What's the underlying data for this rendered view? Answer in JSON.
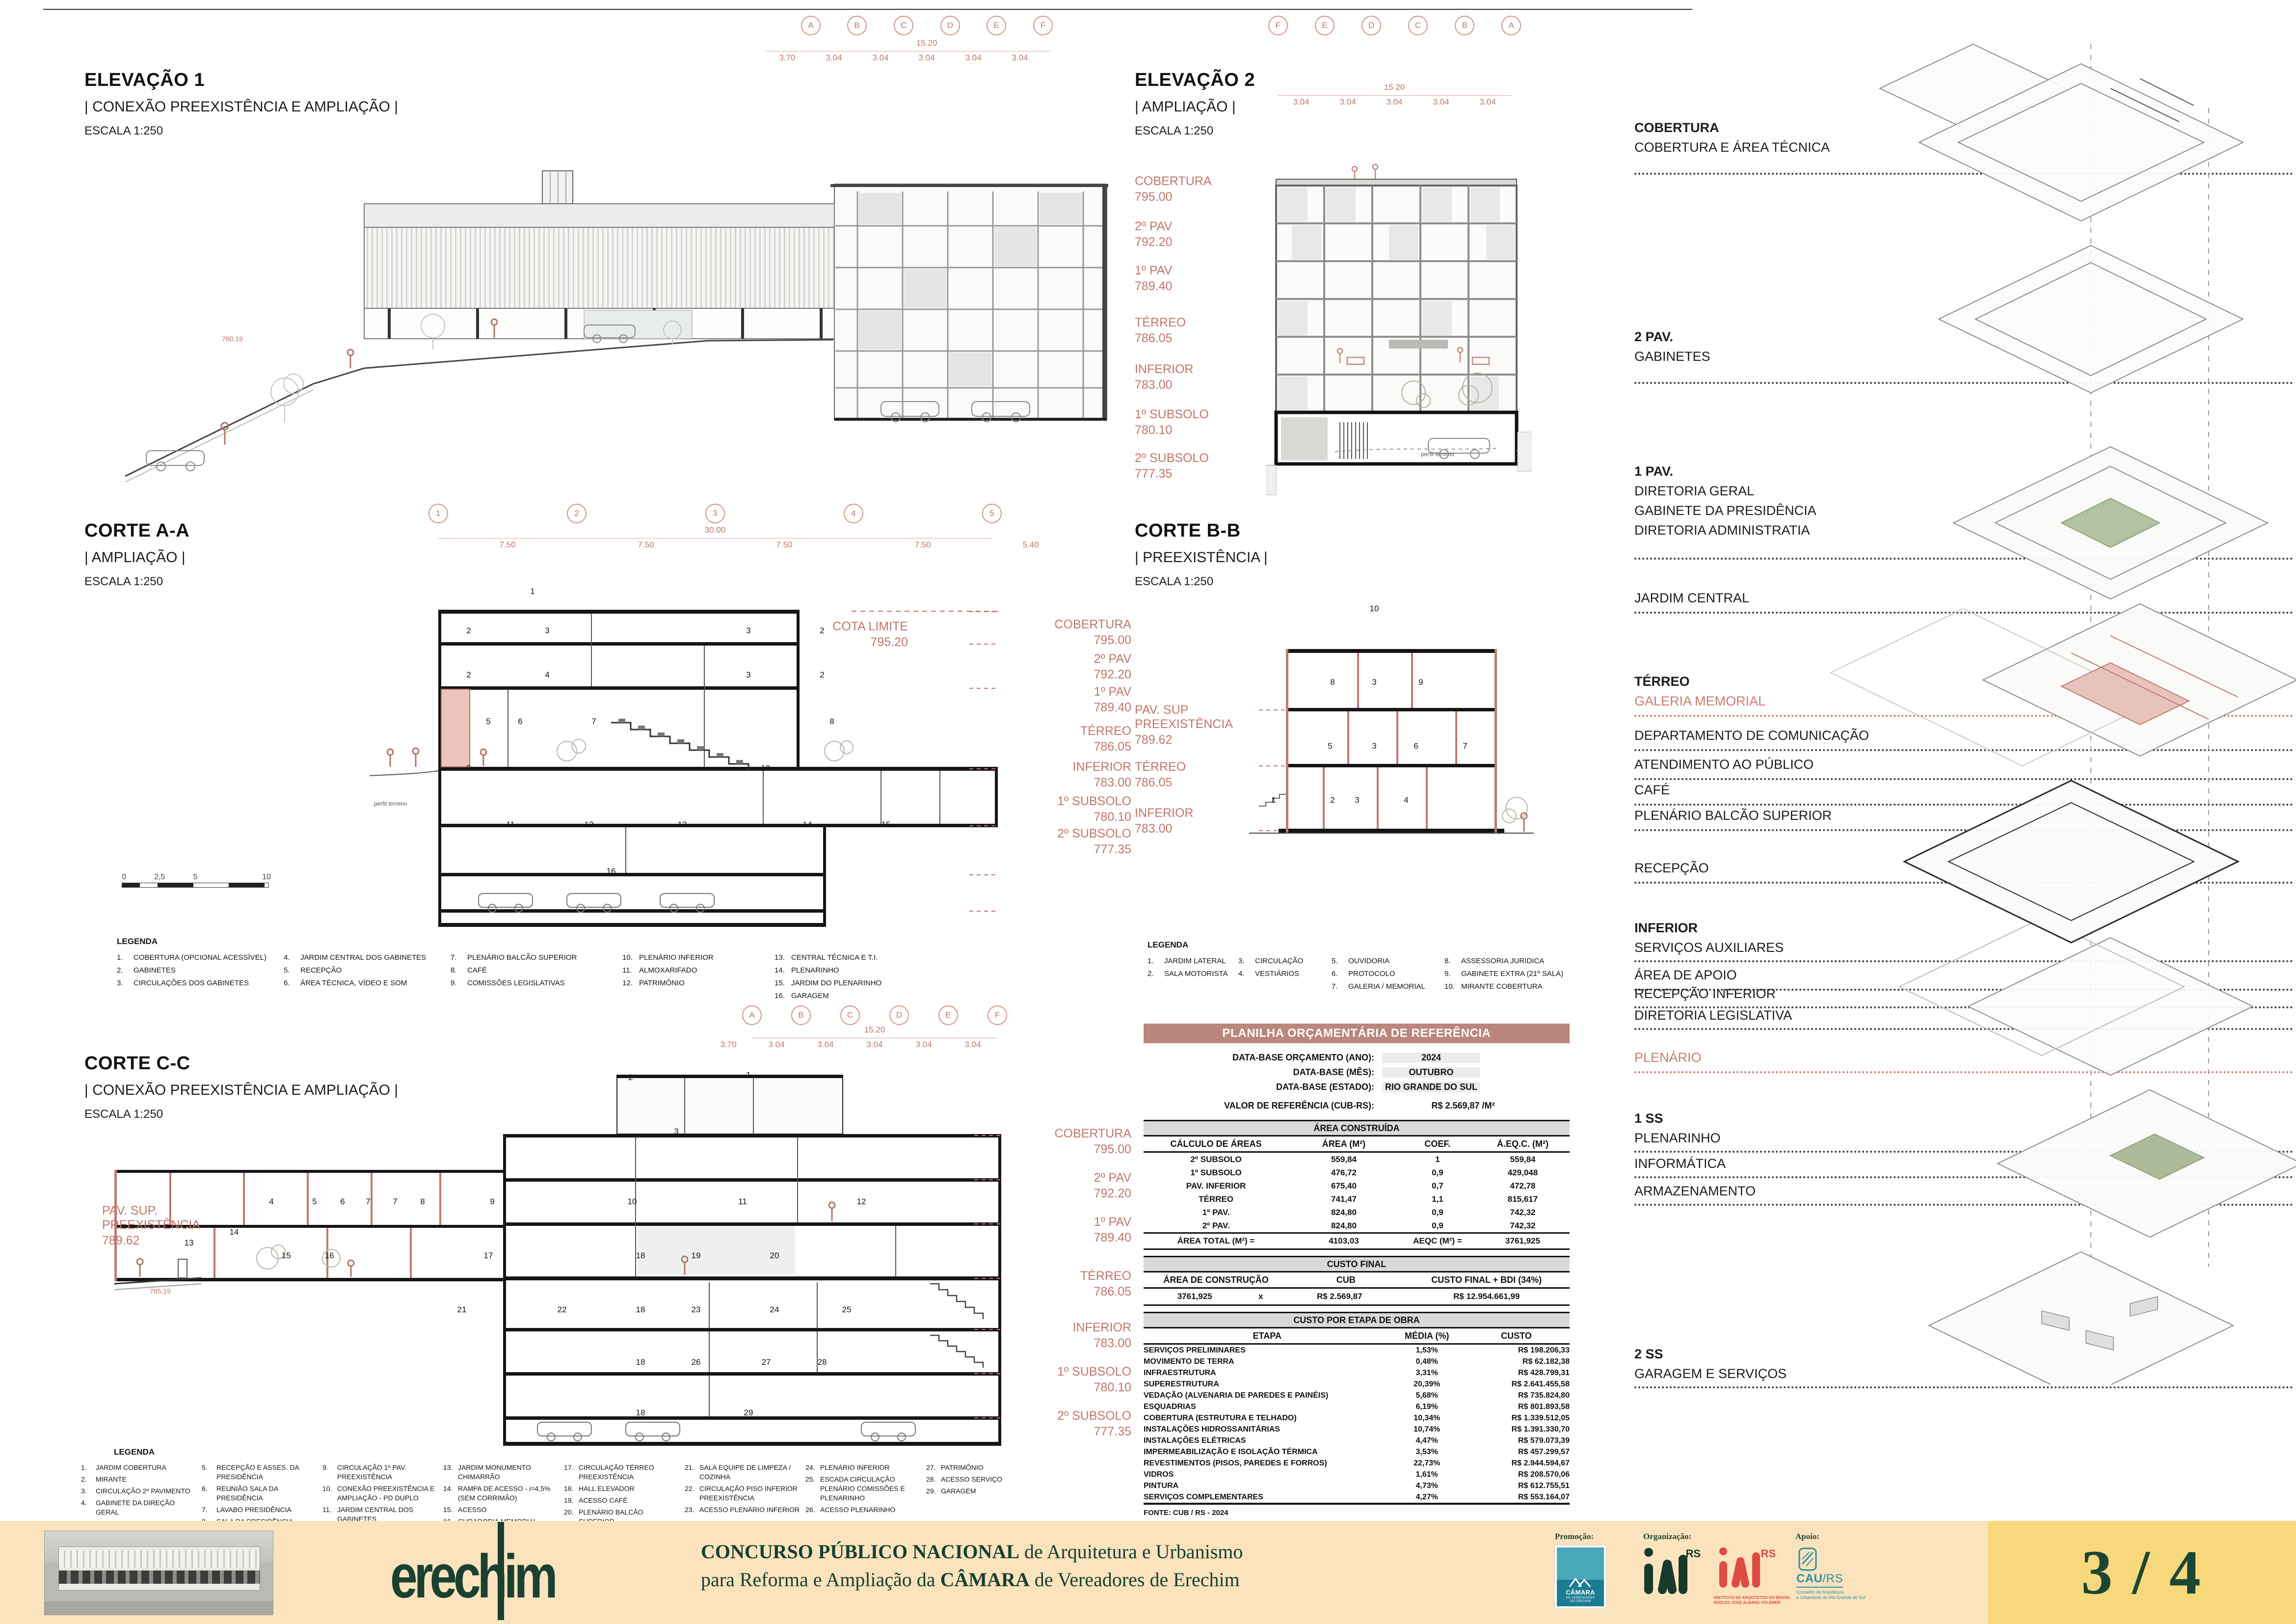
{
  "drawings": {
    "elevacao1": {
      "title": "ELEVAÇÃO 1",
      "subtitle": "| CONEXÃO PREEXISTÊNCIA E AMPLIAÇÃO |",
      "scale": "ESCALA 1:250",
      "grid": [
        "A",
        "B",
        "C",
        "D",
        "E",
        "F"
      ],
      "dim_total": "15.20",
      "dims": [
        "3.70",
        "3.04",
        "3.04",
        "3.04",
        "3.04",
        "3.04"
      ],
      "spot_elevation": "780.19"
    },
    "elevacao2": {
      "title": "ELEVAÇÃO 2",
      "subtitle": "| AMPLIAÇÃO |",
      "scale": "ESCALA 1:250",
      "grid": [
        "F",
        "E",
        "D",
        "C",
        "B",
        "A"
      ],
      "dim_total": "15.20",
      "dims": [
        "3.04",
        "3.04",
        "3.04",
        "3.04",
        "3.04"
      ],
      "terrain_label": "perfil terreno",
      "levels": [
        {
          "name": "COBERTURA",
          "value": "795.00"
        },
        {
          "name": "2º PAV",
          "value": "792.20"
        },
        {
          "name": "1º PAV",
          "value": "789.40"
        },
        {
          "name": "TÉRREO",
          "value": "786.05"
        },
        {
          "name": "INFERIOR",
          "value": "783.00"
        },
        {
          "name": "1º SUBSOLO",
          "value": "780.10"
        },
        {
          "name": "2º SUBSOLO",
          "value": "777.35"
        }
      ]
    },
    "corte_aa": {
      "title": "CORTE A-A",
      "subtitle": "| AMPLIAÇÃO |",
      "scale": "ESCALA 1:250",
      "grid": [
        "1",
        "2",
        "3",
        "4",
        "5"
      ],
      "dim_total": "30.00",
      "dims": [
        "7.50",
        "7.50",
        "7.50",
        "7.50"
      ],
      "dim_right": "5.40",
      "cota_limite_label": "COTA LIMITE",
      "cota_limite_value": "795.20",
      "terrain_label": "perfil terreno",
      "levels": [
        {
          "name": "COBERTURA",
          "value": "795.00"
        },
        {
          "name": "2º PAV",
          "value": "792.20"
        },
        {
          "name": "1º PAV",
          "value": "789.40"
        },
        {
          "name": "TÉRREO",
          "value": "786.05"
        },
        {
          "name": "INFERIOR",
          "value": "783.00"
        },
        {
          "name": "1º SUBSOLO",
          "value": "780.10"
        },
        {
          "name": "2º SUBSOLO",
          "value": "777.35"
        }
      ],
      "scalebar": [
        "0",
        "2,5",
        "5",
        "10"
      ],
      "room_tags": [
        "1",
        "2",
        "3",
        "3",
        "2",
        "2",
        "4",
        "3",
        "2",
        "5",
        "6",
        "7",
        "8",
        "9",
        "10",
        "11",
        "12",
        "13",
        "14",
        "15",
        "16"
      ],
      "legend_title": "LEGENDA",
      "legend_cols": [
        [
          {
            "num": "1.",
            "label": "COBERTURA (OPCIONAL ACESSÍVEL)"
          },
          {
            "num": "2.",
            "label": "GABINETES"
          },
          {
            "num": "3.",
            "label": "CIRCULAÇÕES DOS GABINETES"
          }
        ],
        [
          {
            "num": "4.",
            "label": "JARDIM CENTRAL DOS GABINETES"
          },
          {
            "num": "5.",
            "label": "RECEPÇÃO"
          },
          {
            "num": "6.",
            "label": "ÁREA TÉCNICA, VÍDEO E SOM"
          }
        ],
        [
          {
            "num": "7.",
            "label": "PLENÁRIO BALCÃO SUPERIOR"
          },
          {
            "num": "8.",
            "label": "CAFÉ"
          },
          {
            "num": "9.",
            "label": "COMISSÕES LEGISLATIVAS"
          }
        ],
        [
          {
            "num": "10.",
            "label": "PLENÁRIO INFERIOR"
          },
          {
            "num": "11.",
            "label": "ALMOXARIFADO"
          },
          {
            "num": "12.",
            "label": "PATRIMÔNIO"
          }
        ],
        [
          {
            "num": "13.",
            "label": "CENTRAL TÉCNICA E T.I."
          },
          {
            "num": "14.",
            "label": "PLENARINHO"
          },
          {
            "num": "15.",
            "label": "JARDIM DO PLENARINHO"
          },
          {
            "num": "16.",
            "label": "GARAGEM"
          }
        ]
      ]
    },
    "corte_bb": {
      "title": "CORTE B-B",
      "subtitle": "| PREEXISTÊNCIA |",
      "scale": "ESCALA 1:250",
      "pav_sup_label": "PAV. SUP",
      "pav_sup_label2": "PREEXISTÊNCIA",
      "pav_sup_value": "789.62",
      "levels": [
        {
          "name": "TÉRREO",
          "value": "786.05"
        },
        {
          "name": "INFERIOR",
          "value": "783.00"
        }
      ],
      "room_tags": [
        "10",
        "8",
        "3",
        "9",
        "5",
        "3",
        "6",
        "7",
        "1",
        "2",
        "3",
        "4"
      ],
      "legend_title": "LEGENDA",
      "legend_cols": [
        [
          {
            "num": "1.",
            "label": "JARDIM LATERAL"
          },
          {
            "num": "2.",
            "label": "SALA MOTORISTA"
          }
        ],
        [
          {
            "num": "3.",
            "label": "CIRCULAÇÃO"
          },
          {
            "num": "4.",
            "label": "VESTIÁRIOS"
          }
        ],
        [
          {
            "num": "5.",
            "label": "OUVIDORIA"
          },
          {
            "num": "6.",
            "label": "PROTOCOLO"
          },
          {
            "num": "7.",
            "label": "GALERIA / MEMORIAL"
          }
        ],
        [
          {
            "num": "8.",
            "label": "ASSESSORIA JURIDICA"
          },
          {
            "num": "9.",
            "label": "GABINETE EXTRA (21º SALA)"
          },
          {
            "num": "10.",
            "label": "MIRANTE COBERTURA"
          }
        ]
      ]
    },
    "corte_cc": {
      "title": "CORTE C-C",
      "subtitle": "| CONEXÃO PREEXISTÊNCIA E AMPLIAÇÃO |",
      "scale": "ESCALA 1:250",
      "grid": [
        "A",
        "B",
        "C",
        "D",
        "E",
        "F"
      ],
      "dim_total": "15.20",
      "dims": [
        "3.70",
        "3.04",
        "3.04",
        "3.04",
        "3.04",
        "3.04"
      ],
      "pav_sup_label": "PAV. SUP.",
      "pav_sup_label2": "PREEXISTÊNCIA",
      "pav_sup_value": "789.62",
      "spot_elevation": "785.19",
      "levels": [
        {
          "name": "COBERTURA",
          "value": "795.00"
        },
        {
          "name": "2º PAV",
          "value": "792.20"
        },
        {
          "name": "1º PAV",
          "value": "789.40"
        },
        {
          "name": "TÉRREO",
          "value": "786.05"
        },
        {
          "name": "INFERIOR",
          "value": "783.00"
        },
        {
          "name": "1º SUBSOLO",
          "value": "780.10"
        },
        {
          "name": "2º SUBSOLO",
          "value": "777.35"
        }
      ],
      "room_tags": [
        "2",
        "1",
        "3",
        "4",
        "5",
        "6",
        "7",
        "7",
        "8",
        "9",
        "10",
        "11",
        "12",
        "13",
        "14",
        "15",
        "16",
        "17",
        "18",
        "19",
        "20",
        "21",
        "22",
        "18",
        "23",
        "24",
        "25",
        "18",
        "26",
        "27",
        "28",
        "18",
        "29"
      ],
      "legend_title": "LEGENDA",
      "legend_cols": [
        [
          {
            "num": "1.",
            "label": "JARDIM COBERTURA"
          },
          {
            "num": "2.",
            "label": "MIRANTE"
          },
          {
            "num": "3.",
            "label": "CIRCULAÇÃO 2º PAVIMENTO"
          },
          {
            "num": "4.",
            "label": "GABINETE DA DIREÇÃO GERAL"
          }
        ],
        [
          {
            "num": "5.",
            "label": "RECEPÇÃO E ASSES. DA PRESIDÊNCIA"
          },
          {
            "num": "6.",
            "label": "REUNIÃO SALA DA PRESIDÊNCIA"
          },
          {
            "num": "7.",
            "label": "LAVABO PRESIDÊNCIA"
          },
          {
            "num": "8.",
            "label": "SALA DA PRESIDÊNCIA"
          }
        ],
        [
          {
            "num": "9.",
            "label": "CIRCULAÇÃO 1º PAV. PREEXISTÊNCIA"
          },
          {
            "num": "10.",
            "label": "CONEXÃO PREEXISTÊNCIA E AMPLIAÇÃO - PD DUPLO"
          },
          {
            "num": "11.",
            "label": "JARDIM CENTRAL DOS GABINETES"
          },
          {
            "num": "12.",
            "label": "ESCADA ACESSO RESTRITO"
          }
        ],
        [
          {
            "num": "13.",
            "label": "JARDIM MONUMENTO CHIMARRÃO"
          },
          {
            "num": "14.",
            "label": "RAMPA DE ACESSO - i=4,5% (SEM CORRIMÃO)"
          },
          {
            "num": "15.",
            "label": "ACESSO"
          },
          {
            "num": "16.",
            "label": "CURADORIA MEMORIAL"
          }
        ],
        [
          {
            "num": "17.",
            "label": "CIRCULAÇÃO TÉRREO PREEXISTÊNCIA"
          },
          {
            "num": "18.",
            "label": "HALL ELEVADOR"
          },
          {
            "num": "19.",
            "label": "ACESSO CAFÉ"
          },
          {
            "num": "20.",
            "label": "PLENÁRIO BALCÃO SUPERIOR"
          }
        ],
        [
          {
            "num": "21.",
            "label": "SALA EQUIPE DE LIMPEZA / COZINHA"
          },
          {
            "num": "22.",
            "label": "CIRCULAÇÃO PISO INFERIOR PREEXISTÊNCIA"
          },
          {
            "num": "23.",
            "label": "ACESSO PLENÁRIO INFERIOR"
          }
        ],
        [
          {
            "num": "24.",
            "label": "PLENÁRIO INFERIOR"
          },
          {
            "num": "25.",
            "label": "ESCADA CIRCULAÇÃO PLENÁRIO COMISSÕES E PLENARINHO"
          },
          {
            "num": "26.",
            "label": "ACESSO PLENARINHO"
          }
        ],
        [
          {
            "num": "27.",
            "label": "PATRIMÔNIO"
          },
          {
            "num": "28.",
            "label": "ACESSO SERVIÇO"
          },
          {
            "num": "29.",
            "label": "GARAGEM"
          }
        ]
      ]
    }
  },
  "planilha": {
    "title": "PLANILHA ORÇAMENTÁRIA DE REFERÊNCIA",
    "info": [
      {
        "label": "DATA-BASE ORÇAMENTO (ANO):",
        "value": "2024"
      },
      {
        "label": "DATA-BASE (MÊS):",
        "value": "OUTUBRO"
      },
      {
        "label": "DATA-BASE (ESTADO):",
        "value": "RIO GRANDE DO SUL"
      }
    ],
    "valor_label": "VALOR DE REFERÊNCIA (CUB-RS):",
    "valor_value": "R$ 2.569,87  /M²",
    "area": {
      "title": "ÁREA CONSTRUÍDA",
      "headers": [
        "CÁLCULO DE ÁREAS",
        "ÁREA (M²)",
        "COEF.",
        "Á.EQ.C. (M²)"
      ],
      "rows": [
        [
          "2º SUBSOLO",
          "559,84",
          "1",
          "559,84"
        ],
        [
          "1º SUBSOLO",
          "476,72",
          "0,9",
          "429,048"
        ],
        [
          "PAV. INFERIOR",
          "675,40",
          "0,7",
          "472,78"
        ],
        [
          "TÉRREO",
          "741,47",
          "1,1",
          "815,617"
        ],
        [
          "1º PAV.",
          "824,80",
          "0,9",
          "742,32"
        ],
        [
          "2º PAV.",
          "824,80",
          "0,9",
          "742,32"
        ]
      ],
      "total": [
        "ÁREA TOTAL (M²) =",
        "4103,03",
        "AEQC (M²) =",
        "3761,925"
      ]
    },
    "custo": {
      "title": "CUSTO FINAL",
      "headers": [
        "ÁREA DE CONSTRUÇÃO",
        "CUB",
        "CUSTO FINAL + BDI (34%)"
      ],
      "row": [
        "3761,925",
        "x",
        "R$ 2.569,87",
        "R$ 12.954.661,99"
      ]
    },
    "etapas": {
      "title": "CUSTO POR ETAPA DE OBRA",
      "headers": [
        "ETAPA",
        "MÉDIA (%)",
        "CUSTO"
      ],
      "rows": [
        [
          "SERVIÇOS PRELIMINARES",
          "1,53%",
          "R$ 198.206,33"
        ],
        [
          "MOVIMENTO DE TERRA",
          "0,48%",
          "R$ 62.182,38"
        ],
        [
          "INFRAESTRUTURA",
          "3,31%",
          "R$ 428.799,31"
        ],
        [
          "SUPERESTRUTURA",
          "20,39%",
          "R$ 2.641.455,58"
        ],
        [
          "VEDAÇÃO (ALVENARIA DE PAREDES E PAINÉIS)",
          "5,68%",
          "R$ 735.824,80"
        ],
        [
          "ESQUADRIAS",
          "6,19%",
          "R$ 801.893,58"
        ],
        [
          "COBERTURA (ESTRUTURA E TELHADO)",
          "10,34%",
          "R$ 1.339.512,05"
        ],
        [
          "INSTALAÇÕES HIDROSSANITÁRIAS",
          "10,74%",
          "R$ 1.391.330,70"
        ],
        [
          "INSTALAÇÕES ELÉTRICAS",
          "4,47%",
          "R$ 579.073,39"
        ],
        [
          "IMPERMEABILIZAÇÃO E ISOLAÇÃO TÉRMICA",
          "3,53%",
          "R$ 457.299,57"
        ],
        [
          "REVESTIMENTOS (PISOS, PAREDES E FORROS)",
          "22,73%",
          "R$ 2.944.594,67"
        ],
        [
          "VIDROS",
          "1,61%",
          "R$ 208.570,06"
        ],
        [
          "PINTURA",
          "4,73%",
          "R$ 612.755,51"
        ],
        [
          "SERVIÇOS COMPLEMENTARES",
          "4,27%",
          "R$ 553.164,07"
        ]
      ],
      "fonte": "FONTE: CUB / RS - 2024"
    }
  },
  "axon": {
    "groups": [
      {
        "title": "COBERTURA",
        "lines": [
          "COBERTURA E ÁREA TÉCNICA"
        ]
      },
      {
        "title": "2 PAV.",
        "lines": [
          "GABINETES"
        ]
      },
      {
        "title": "1 PAV.",
        "lines": [
          "DIRETORIA GERAL",
          "GABINETE DA PRESIDÊNCIA",
          "DIRETORIA ADMINISTRATIA"
        ]
      },
      {
        "lines": [
          "JARDIM CENTRAL"
        ]
      },
      {
        "title": "TÉRREO",
        "lines": [
          "GALERIA MEMORIAL"
        ],
        "accent": true
      },
      {
        "lines": [
          "DEPARTAMENTO DE COMUNICAÇÃO"
        ]
      },
      {
        "lines": [
          "ATENDIMENTO AO PÚBLICO"
        ]
      },
      {
        "lines": [
          "CAFÉ"
        ]
      },
      {
        "lines": [
          "PLENÁRIO BALCÃO SUPERIOR"
        ]
      },
      {
        "lines": [
          "RECEPÇÃO"
        ]
      },
      {
        "title": "INFERIOR",
        "lines": [
          "SERVIÇOS AUXILIARES"
        ]
      },
      {
        "lines": [
          "ÁREA DE APOIO"
        ]
      },
      {
        "lines": [
          "RECEPÇÃO INFERIOR"
        ]
      },
      {
        "lines": [
          "DIRETORIA LEGISLATIVA"
        ]
      },
      {
        "lines": [
          "PLENÁRIO"
        ],
        "accent": true
      },
      {
        "title": "1 SS",
        "lines": [
          "PLENARINHO"
        ]
      },
      {
        "lines": [
          "INFORMÁTICA"
        ]
      },
      {
        "lines": [
          "ARMAZENAMENTO"
        ]
      },
      {
        "title": "2 SS",
        "lines": [
          "GARAGEM E SERVIÇOS"
        ]
      }
    ]
  },
  "footer": {
    "logo_text": "erechim",
    "title_bold1": "CONCURSO PÚBLICO NACIONAL",
    "title_rest1": " de Arquitetura e Urbanismo",
    "title_pre2": "para Reforma e Ampliação da ",
    "title_bold2": "CÂMARA",
    "title_rest2": " de Vereadores de Erechim",
    "promocao_label": "Promoção:",
    "organizacao_label": "Organização:",
    "apoio_label": "Apoio:",
    "camara_logo": {
      "line1": "CÂMARA",
      "line2": "DE VEREADORES",
      "line3": "DE ERECHIM"
    },
    "iab_rs": "RS",
    "iab_caption1": "INSTITUTO DE ARQUITETOS DO BRASIL",
    "iab_caption2": "NÚCLEO JOSÉ ALBANO VOLKMER",
    "cau_word": "CAU",
    "cau_word2": "/RS",
    "cau_caption1": "Conselho de Arquitetura",
    "cau_caption2": "e Urbanismo do Rio Grande do Sul",
    "page": "3 / 4"
  },
  "colors": {
    "accent_salmon": "#c0766a",
    "table_header_bg": "#bb867c",
    "footer_bg": "#fbe3bd",
    "footer_badge_bg": "#f8d87c",
    "footer_green": "#1a4031",
    "logo_teal": "#2a8fa3",
    "logo_red": "#e04a45"
  }
}
